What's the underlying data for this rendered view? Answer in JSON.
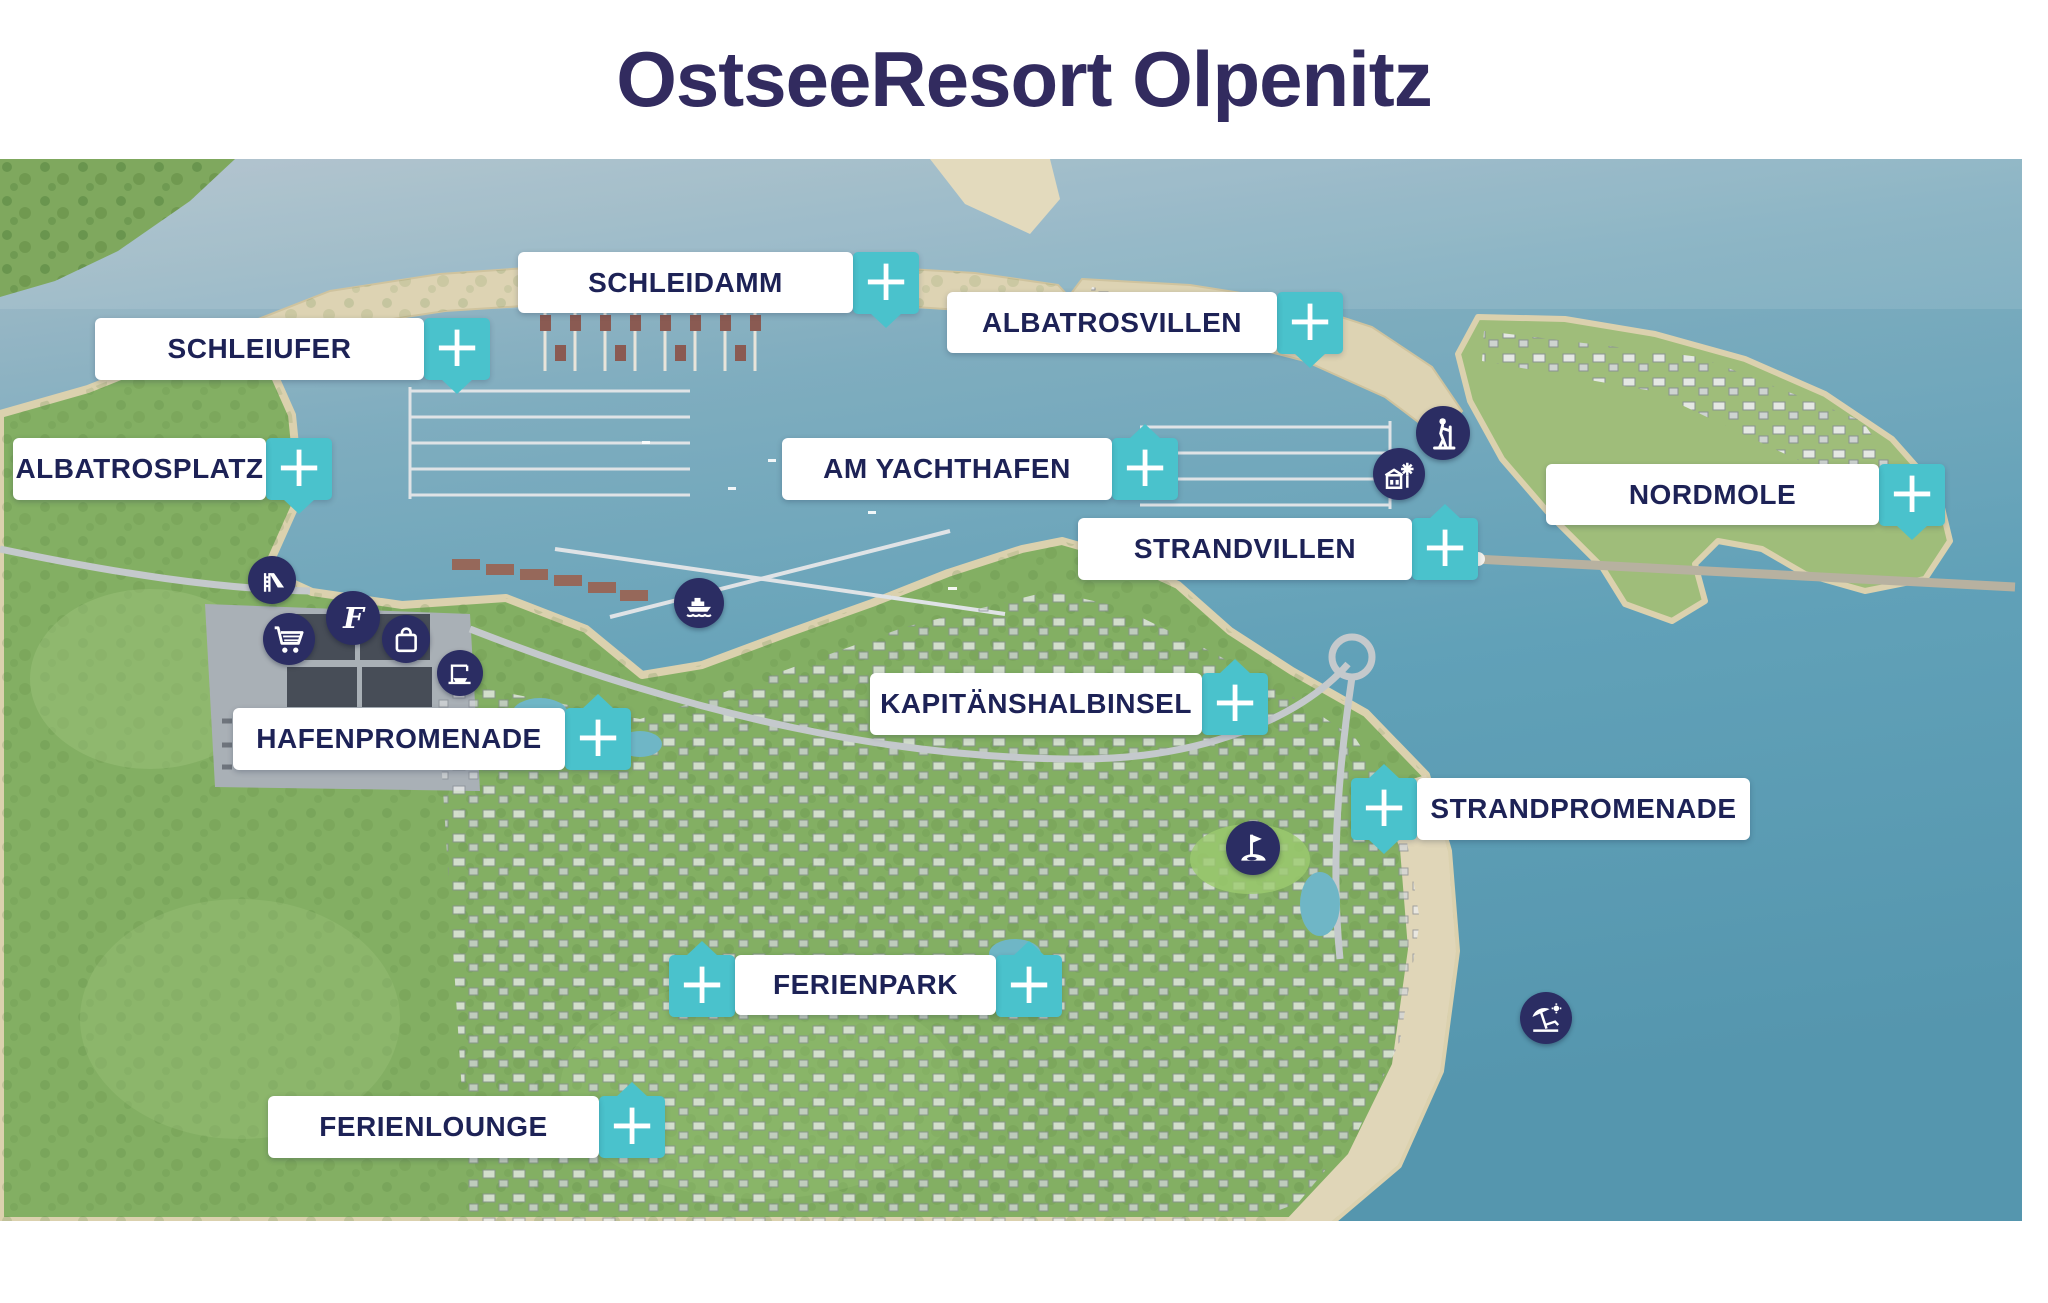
{
  "title": "OstseeResort Olpenitz",
  "plus_symbol": "+",
  "colors": {
    "accent_teal": "#4ac2cc",
    "label_text": "#1d2256",
    "title_text": "#322b5f",
    "icon_circle": "#2b2d63"
  },
  "labels": [
    {
      "id": "schleidamm",
      "text": "SCHLEIDAMM",
      "box": {
        "x": 518,
        "y": 252,
        "w": 335,
        "h": 61
      },
      "pluses": [
        {
          "x": 853,
          "y": 252,
          "tails": [
            "down"
          ]
        }
      ]
    },
    {
      "id": "schleiufer",
      "text": "SCHLEIUFER",
      "box": {
        "x": 95,
        "y": 318,
        "w": 329,
        "h": 62
      },
      "pluses": [
        {
          "x": 424,
          "y": 318,
          "tails": [
            "down"
          ]
        }
      ]
    },
    {
      "id": "albatrosvillen",
      "text": "ALBATROSVILLEN",
      "box": {
        "x": 947,
        "y": 292,
        "w": 330,
        "h": 61
      },
      "pluses": [
        {
          "x": 1277,
          "y": 292,
          "tails": [
            "down"
          ]
        }
      ]
    },
    {
      "id": "albatrosplatz",
      "text": "ALBATROSPLATZ",
      "box": {
        "x": 13,
        "y": 438,
        "w": 253,
        "h": 62
      },
      "pluses": [
        {
          "x": 266,
          "y": 438,
          "tails": [
            "down"
          ]
        }
      ]
    },
    {
      "id": "am-yachthafen",
      "text": "AM YACHTHAFEN",
      "box": {
        "x": 782,
        "y": 438,
        "w": 330,
        "h": 62
      },
      "pluses": [
        {
          "x": 1112,
          "y": 438,
          "tails": [
            "up"
          ]
        }
      ]
    },
    {
      "id": "nordmole",
      "text": "NORDMOLE",
      "box": {
        "x": 1546,
        "y": 464,
        "w": 333,
        "h": 61
      },
      "pluses": [
        {
          "x": 1879,
          "y": 464,
          "tails": [
            "down"
          ]
        }
      ]
    },
    {
      "id": "strandvillen",
      "text": "STRANDVILLEN",
      "box": {
        "x": 1078,
        "y": 518,
        "w": 334,
        "h": 62
      },
      "pluses": [
        {
          "x": 1412,
          "y": 518,
          "tails": [
            "up"
          ]
        }
      ]
    },
    {
      "id": "kapitaenshalbinsel",
      "text": "KAPITÄNSHALBINSEL",
      "box": {
        "x": 870,
        "y": 673,
        "w": 332,
        "h": 62
      },
      "pluses": [
        {
          "x": 1202,
          "y": 673,
          "tails": [
            "up"
          ]
        }
      ]
    },
    {
      "id": "hafenpromenade",
      "text": "HAFENPROMENADE",
      "box": {
        "x": 233,
        "y": 708,
        "w": 332,
        "h": 62
      },
      "pluses": [
        {
          "x": 565,
          "y": 708,
          "tails": [
            "up"
          ]
        }
      ]
    },
    {
      "id": "strandpromenade",
      "text": "STRANDPROMENADE",
      "box": {
        "x": 1417,
        "y": 778,
        "w": 333,
        "h": 62
      },
      "pluses": [
        {
          "x": 1351,
          "y": 778,
          "tails": [
            "up",
            "down"
          ],
          "side": "left"
        }
      ]
    },
    {
      "id": "ferienpark",
      "text": "FERIENPARK",
      "box": {
        "x": 735,
        "y": 955,
        "w": 261,
        "h": 60
      },
      "pluses": [
        {
          "x": 669,
          "y": 955,
          "tails": [
            "up"
          ],
          "side": "left"
        },
        {
          "x": 996,
          "y": 955,
          "tails": [
            "up"
          ]
        }
      ]
    },
    {
      "id": "ferienlounge",
      "text": "FERIENLOUNGE",
      "box": {
        "x": 268,
        "y": 1096,
        "w": 331,
        "h": 62
      },
      "pluses": [
        {
          "x": 599,
          "y": 1096,
          "tails": [
            "up"
          ]
        }
      ]
    }
  ],
  "map_icons": [
    {
      "id": "slide",
      "name": "playground-slide-icon",
      "x": 272,
      "y": 580,
      "d": 48
    },
    {
      "id": "cart",
      "name": "shopping-cart-icon",
      "x": 289,
      "y": 639,
      "d": 52
    },
    {
      "id": "flogo",
      "name": "script-f-logo-icon",
      "x": 353,
      "y": 618,
      "d": 54
    },
    {
      "id": "bag",
      "name": "shopping-bag-icon",
      "x": 406,
      "y": 639,
      "d": 48
    },
    {
      "id": "boatlift",
      "name": "boat-lift-crane-icon",
      "x": 460,
      "y": 673,
      "d": 46
    },
    {
      "id": "ferry",
      "name": "ferry-boat-icon",
      "x": 699,
      "y": 603,
      "d": 50
    },
    {
      "id": "hiking",
      "name": "hiking-person-icon",
      "x": 1443,
      "y": 433,
      "d": 54
    },
    {
      "id": "mill",
      "name": "windmill-building-icon",
      "x": 1399,
      "y": 474,
      "d": 52
    },
    {
      "id": "golf",
      "name": "golf-flag-icon",
      "x": 1253,
      "y": 848,
      "d": 54
    },
    {
      "id": "beach",
      "name": "beach-umbrella-icon",
      "x": 1546,
      "y": 1018,
      "d": 52
    }
  ]
}
